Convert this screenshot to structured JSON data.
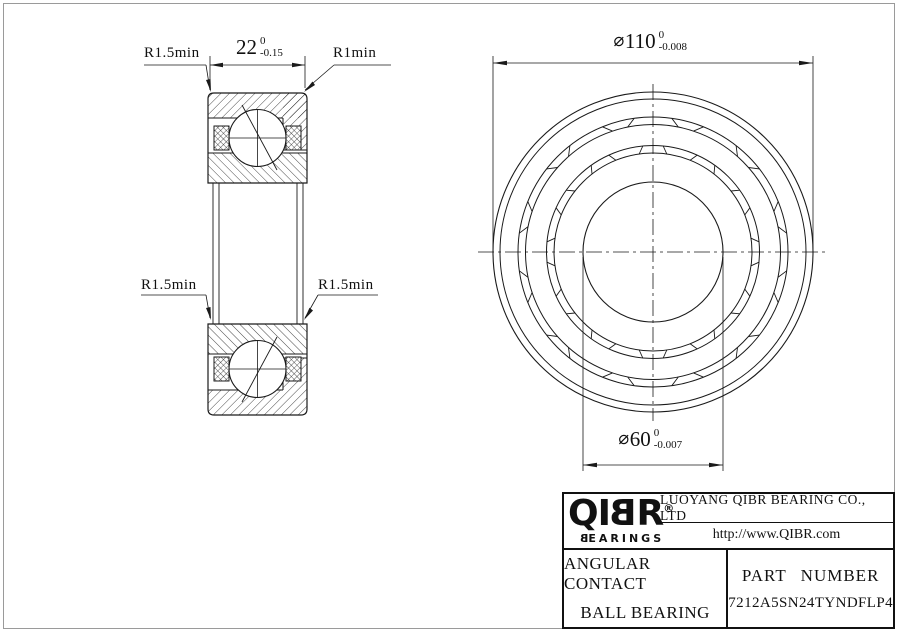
{
  "left_view": {
    "width_dim": {
      "value": "22",
      "tol_upper": "0",
      "tol_lower": "-0.15"
    },
    "labels": {
      "top_left": "R1.5min",
      "top_right": "R1min",
      "bottom_left": "R1.5min",
      "bottom_right": "R1.5min"
    }
  },
  "right_view": {
    "od_dim": {
      "phi": "⌀",
      "value": "110",
      "tol_upper": "0",
      "tol_lower": "-0.008"
    },
    "bore_dim": {
      "phi": "⌀",
      "value": "60",
      "tol_upper": "0",
      "tol_lower": "-0.007"
    }
  },
  "title_block": {
    "logo": {
      "brand_pre": "QI",
      "brand_b": "B",
      "brand_post": "R",
      "registered": "®",
      "sub_b": "B",
      "sub_rest": "EARINGS"
    },
    "company": "LUOYANG QIBR BEARING CO., LTD",
    "website": "http://www.QIBR.com",
    "product_line1": "ANGULAR CONTACT",
    "product_line2": "BALL BEARING",
    "part_label": "PART NUMBER",
    "part_number": "7212A5SN24TYNDFLP4"
  },
  "colors": {
    "line": "#1a1a1a",
    "frame": "#9a9a9a",
    "text": "#111111",
    "background": "#ffffff"
  }
}
